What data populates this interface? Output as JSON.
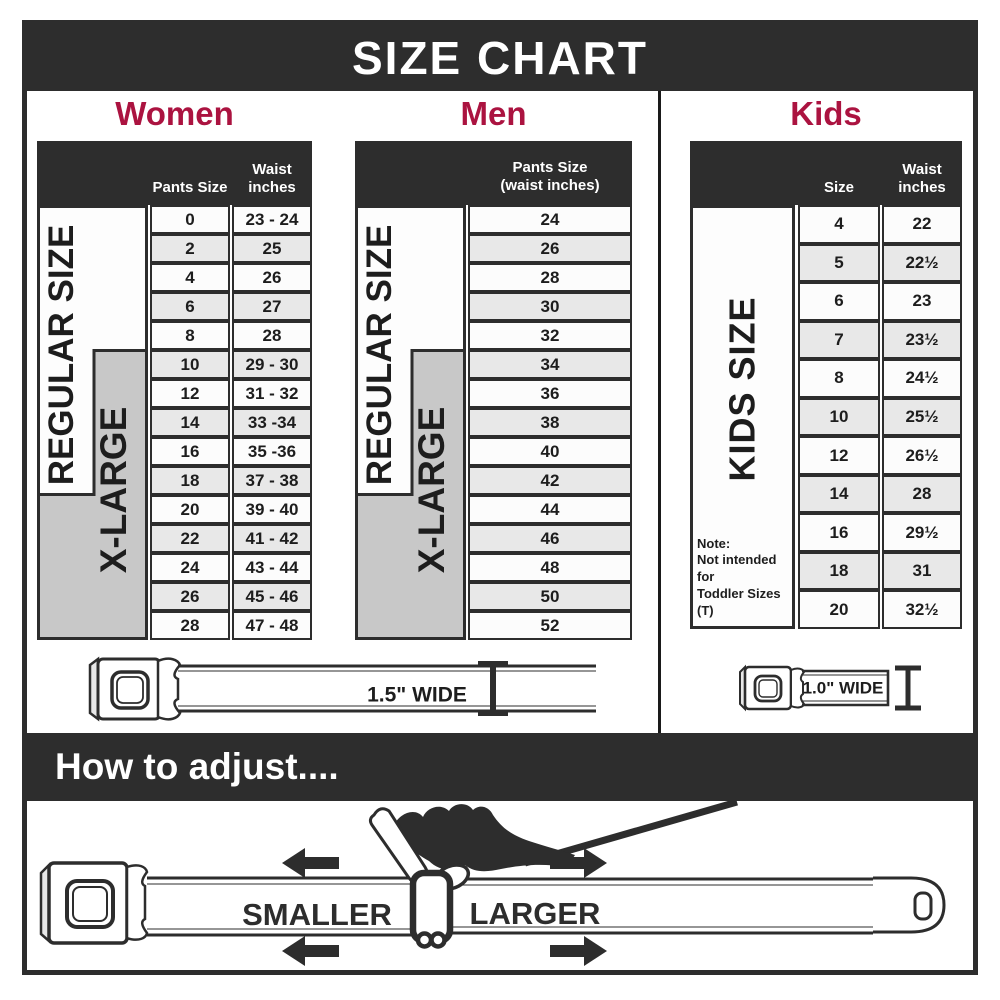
{
  "title": "SIZE CHART",
  "colors": {
    "dark": "#2d2d2d",
    "accent_red": "#ab1340",
    "row_white": "#fcfcfc",
    "row_gray": "#e8e8e8",
    "xlarge_block_gray": "#c8c8c8"
  },
  "women": {
    "heading": "Women",
    "col_header_size": "Pants Size",
    "col_header_waist": "Waist\ninches",
    "regular_label": "REGULAR SIZE",
    "xlarge_label": "X-LARGE",
    "rows": [
      {
        "size": "0",
        "waist": "23 - 24"
      },
      {
        "size": "2",
        "waist": "25"
      },
      {
        "size": "4",
        "waist": "26"
      },
      {
        "size": "6",
        "waist": "27"
      },
      {
        "size": "8",
        "waist": "28"
      },
      {
        "size": "10",
        "waist": "29 - 30"
      },
      {
        "size": "12",
        "waist": "31 - 32"
      },
      {
        "size": "14",
        "waist": "33 -34"
      },
      {
        "size": "16",
        "waist": "35 -36"
      },
      {
        "size": "18",
        "waist": "37 - 38"
      },
      {
        "size": "20",
        "waist": "39 - 40"
      },
      {
        "size": "22",
        "waist": "41 - 42"
      },
      {
        "size": "24",
        "waist": "43 - 44"
      },
      {
        "size": "26",
        "waist": "45 - 46"
      },
      {
        "size": "28",
        "waist": "47 - 48"
      }
    ]
  },
  "men": {
    "heading": "Men",
    "col_header": "Pants Size\n(waist inches)",
    "regular_label": "REGULAR SIZE",
    "xlarge_label": "X-LARGE",
    "rows": [
      "24",
      "26",
      "28",
      "30",
      "32",
      "34",
      "36",
      "38",
      "40",
      "42",
      "44",
      "46",
      "48",
      "50",
      "52"
    ]
  },
  "kids": {
    "heading": "Kids",
    "col_header_size": "Size",
    "col_header_waist": "Waist\ninches",
    "side_label": "KIDS SIZE",
    "note": "Note:\nNot intended for\nToddler Sizes (T)",
    "rows": [
      {
        "size": "4",
        "waist": "22"
      },
      {
        "size": "5",
        "waist": "22½"
      },
      {
        "size": "6",
        "waist": "23"
      },
      {
        "size": "7",
        "waist": "23½"
      },
      {
        "size": "8",
        "waist": "24½"
      },
      {
        "size": "10",
        "waist": "25½"
      },
      {
        "size": "12",
        "waist": "26½"
      },
      {
        "size": "14",
        "waist": "28"
      },
      {
        "size": "16",
        "waist": "29½"
      },
      {
        "size": "18",
        "waist": "31"
      },
      {
        "size": "20",
        "waist": "32½"
      }
    ]
  },
  "belts": {
    "adult_width_label": "1.5\" WIDE",
    "kids_width_label": "1.0\" WIDE"
  },
  "adjust": {
    "heading": "How to adjust....",
    "smaller_label": "SMALLER",
    "larger_label": "LARGER"
  }
}
